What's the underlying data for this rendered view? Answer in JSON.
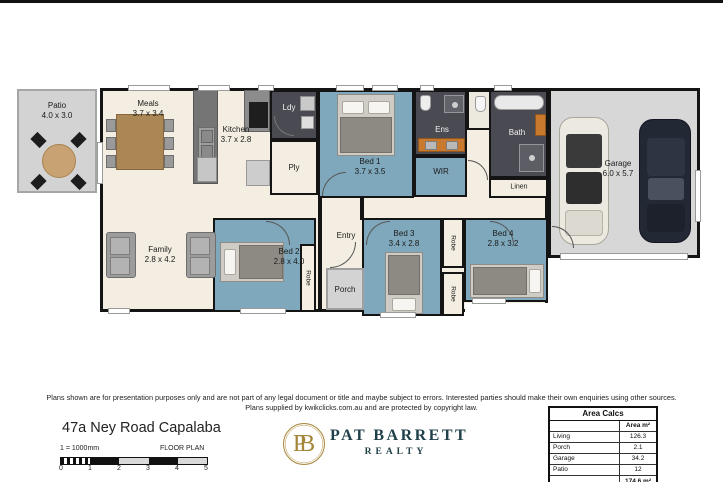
{
  "colors": {
    "wall": "#141414",
    "floor_cream": "#f3eee1",
    "room_blue": "#7fa8bc",
    "tile_dark": "#4a4a52",
    "outdoor_gray": "#d3d3d3",
    "garage_gray": "#d7d7d7",
    "vanity_orange": "#c9792e",
    "wood": "#ab8756",
    "brand_gold": "#a5873c",
    "brand_green": "#20414a"
  },
  "plan": {
    "patio": {
      "name": "Patio",
      "dims": "4.0 x 3.0"
    },
    "meals": {
      "name": "Meals",
      "dims": "3.7 x 3.4"
    },
    "kitchen": {
      "name": "Kitchen",
      "dims": "3.7 x 2.8"
    },
    "ldy": {
      "name": "Ldy"
    },
    "ply": {
      "name": "Ply"
    },
    "bed1": {
      "name": "Bed 1",
      "dims": "3.7 x 3.5"
    },
    "ens": {
      "name": "Ens"
    },
    "wir": {
      "name": "WIR"
    },
    "bath": {
      "name": "Bath"
    },
    "linen": {
      "name": "Linen"
    },
    "garage": {
      "name": "Garage",
      "dims": "6.0 x 5.7"
    },
    "family": {
      "name": "Family",
      "dims": "2.8 x 4.2"
    },
    "bed2": {
      "name": "Bed 2",
      "dims": "2.8 x 4.0"
    },
    "entry": {
      "name": "Entry"
    },
    "porch": {
      "name": "Porch"
    },
    "bed3": {
      "name": "Bed 3",
      "dims": "3.4 x 2.8"
    },
    "bed4": {
      "name": "Bed 4",
      "dims": "2.8 x 3.2"
    },
    "robe_label": "Robe"
  },
  "footer": {
    "disclaimer_line1": "Plans shown are for presentation purposes only and are not part of any legal document or title and maybe subject to errors. Interested parties should make their own enquiries using other sources.",
    "disclaimer_line2": "Plans supplied by kwikclicks.com.au and are protected by copyright law.",
    "address": "47a Ney Road Capalaba",
    "scale_label": "1 = 1000mm",
    "plan_type": "FLOOR PLAN",
    "scale_ticks": [
      "0",
      "1",
      "2",
      "3",
      "4",
      "5"
    ],
    "logo": {
      "monogram": "PB",
      "name": "PAT BARRETT",
      "subtitle": "REALTY"
    },
    "area_table": {
      "title": "Area Calcs",
      "col_header": "Area m²",
      "rows": [
        {
          "label": "Living",
          "value": "126.3"
        },
        {
          "label": "Porch",
          "value": "2.1"
        },
        {
          "label": "Garage",
          "value": "34.2"
        },
        {
          "label": "Patio",
          "value": "12"
        }
      ],
      "total": "174.6 m²"
    }
  }
}
